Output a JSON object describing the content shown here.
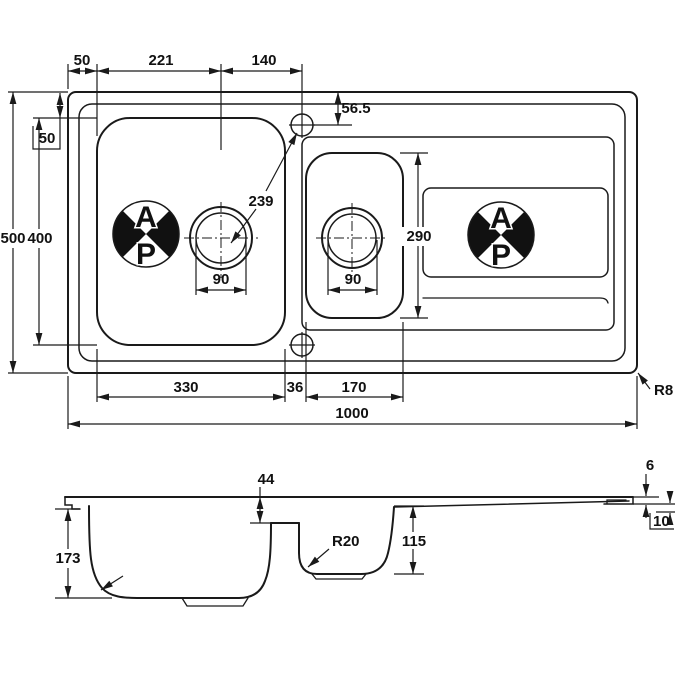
{
  "colors": {
    "ink": "#1a1a1a",
    "background": "#ffffff"
  },
  "plan": {
    "left_overhang": "50",
    "bowl_edge_to_drain": "221",
    "drain_to_tap": "140",
    "tap_from_edge": "56.5",
    "top_overhang": "50",
    "overall_depth": "500",
    "bowl_length": "400",
    "tap_to_drain": "239",
    "main_drain_dia": "90",
    "half_drain_dia": "90",
    "half_bowl_length": "290",
    "main_bowl_width": "330",
    "bowl_gap": "36",
    "half_bowl_width": "170",
    "overall_length": "1000",
    "corner_radius": "R8"
  },
  "section": {
    "ledge_depth": "44",
    "main_bowl_depth": "173",
    "main_bowl_radius": "R40",
    "half_bowl_radius": "R20",
    "half_bowl_depth": "115",
    "rim_height": "6",
    "end_height": "10"
  },
  "logo": {
    "top": "A",
    "bottom": "P"
  }
}
